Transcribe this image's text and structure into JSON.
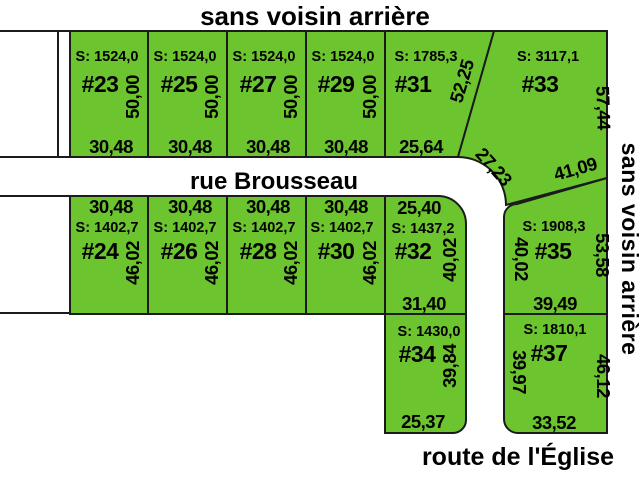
{
  "colors": {
    "lot_fill": "#6cc52f",
    "lot_number": "#d5281b",
    "line": "#1b1b1b",
    "background": "#ffffff"
  },
  "boundaries": {
    "top": "sans voisin arrière",
    "right": "sans voisin arrière"
  },
  "streets": {
    "middle": "rue Brousseau",
    "bottom": "route de l'Église"
  },
  "lots": [
    {
      "number": "#23",
      "surface": "S: 1524,0",
      "dims": {
        "width": "30,48",
        "depth": "50,00"
      }
    },
    {
      "number": "#25",
      "surface": "S: 1524,0",
      "dims": {
        "width": "30,48",
        "depth": "50,00"
      }
    },
    {
      "number": "#27",
      "surface": "S: 1524,0",
      "dims": {
        "width": "30,48",
        "depth": "50,00"
      }
    },
    {
      "number": "#29",
      "surface": "S: 1524,0",
      "dims": {
        "width": "30,48",
        "depth": "50,00"
      }
    },
    {
      "number": "#31",
      "surface": "S: 1785,3",
      "dims": {
        "front": "25,64",
        "side": "52,25"
      }
    },
    {
      "number": "#33",
      "surface": "S: 3117,1",
      "dims": {
        "right": "57,44",
        "curve": "27,23",
        "south": "41,09"
      }
    },
    {
      "number": "#24",
      "surface": "S: 1402,7",
      "dims": {
        "width": "30,48",
        "depth": "46,02"
      }
    },
    {
      "number": "#26",
      "surface": "S: 1402,7",
      "dims": {
        "width": "30,48",
        "depth": "46,02"
      }
    },
    {
      "number": "#28",
      "surface": "S: 1402,7",
      "dims": {
        "width": "30,48",
        "depth": "46,02"
      }
    },
    {
      "number": "#30",
      "surface": "S: 1402,7",
      "dims": {
        "width": "30,48",
        "depth": "46,02"
      }
    },
    {
      "number": "#32",
      "surface": "S: 1437,2",
      "dims": {
        "top": "25,40",
        "right": "40,02",
        "bottom": "31,40"
      }
    },
    {
      "number": "#34",
      "surface": "S: 1430,0",
      "dims": {
        "right": "39,84",
        "bottom": "25,37"
      }
    },
    {
      "number": "#35",
      "surface": "S: 1908,3",
      "dims": {
        "left": "40,02",
        "right": "53,58",
        "bottom": "39,49"
      }
    },
    {
      "number": "#37",
      "surface": "S: 1810,1",
      "dims": {
        "left": "39,97",
        "right": "46,12",
        "bottom": "33,52"
      }
    }
  ]
}
